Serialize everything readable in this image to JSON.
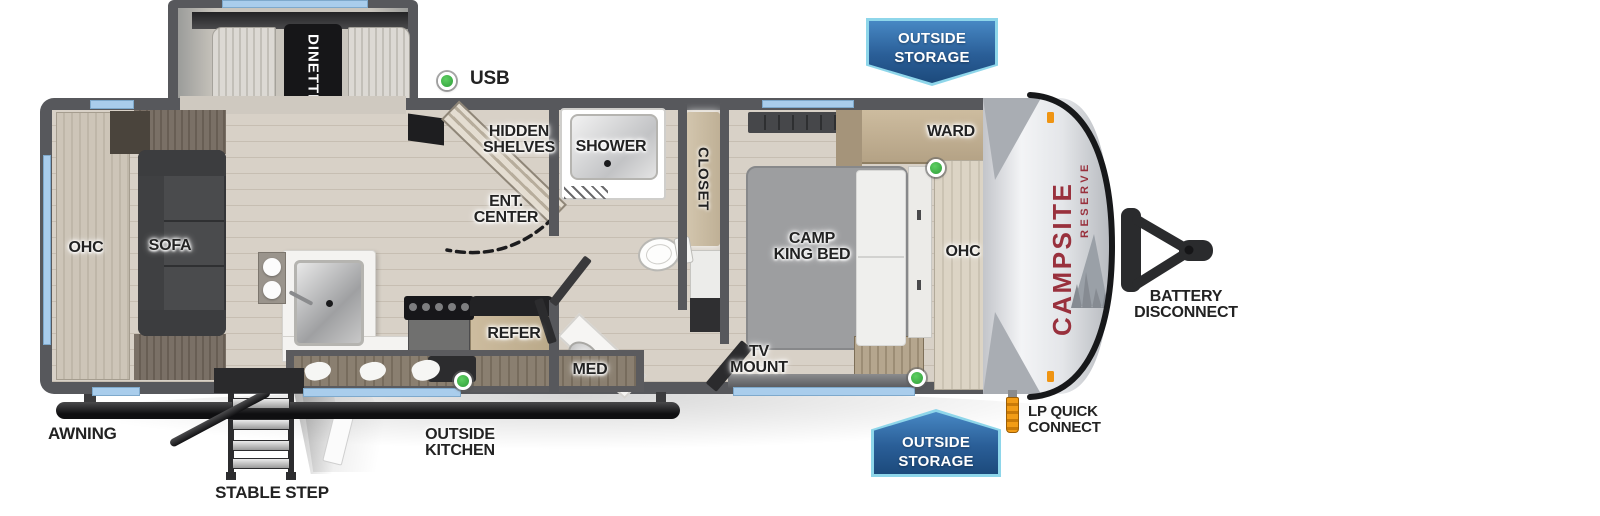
{
  "title": "Campsite Reserve travel trailer floorplan",
  "brand": {
    "name": "CAMPSITE",
    "series": "RESERVE"
  },
  "badges": {
    "top": {
      "line1": "OUTSIDE",
      "line2": "STORAGE"
    },
    "bottom": {
      "line1": "OUTSIDE",
      "line2": "STORAGE"
    }
  },
  "rooms": {
    "dinette": "DINETTE",
    "usb": "USB",
    "ohc_rear": "OHC",
    "sofa": "SOFA",
    "hidden_shelves": {
      "line1": "HIDDEN",
      "line2": "SHELVES"
    },
    "ent_center": {
      "line1": "ENT.",
      "line2": "CENTER"
    },
    "shower": "SHOWER",
    "closet": "CLOSET",
    "med": "MED",
    "refer": "REFER",
    "ward": "WARD",
    "camp_king_bed": {
      "line1": "CAMP",
      "line2": "KING BED"
    },
    "ohc_bedroom": "OHC",
    "tv_mount": {
      "line1": "TV",
      "line2": "MOUNT"
    }
  },
  "exterior": {
    "awning": "AWNING",
    "stable_step": "STABLE STEP",
    "outside_kitchen": {
      "line1": "OUTSIDE",
      "line2": "KITCHEN"
    },
    "battery_disconnect": {
      "line1": "BATTERY",
      "line2": "DISCONNECT"
    },
    "lp_quick_connect": {
      "line1": "LP QUICK",
      "line2": "CONNECT"
    }
  },
  "colors": {
    "wall_gray": "#57585c",
    "window_blue": "#a9cdec",
    "usb_green": "#3fae49",
    "badge_border": "#8ed6ea",
    "badge_fill_dark": "#1c4a7c",
    "brand_red": "#99313d",
    "floor_wood": "#d8d1c7",
    "lp_orange": "#ef9412"
  }
}
